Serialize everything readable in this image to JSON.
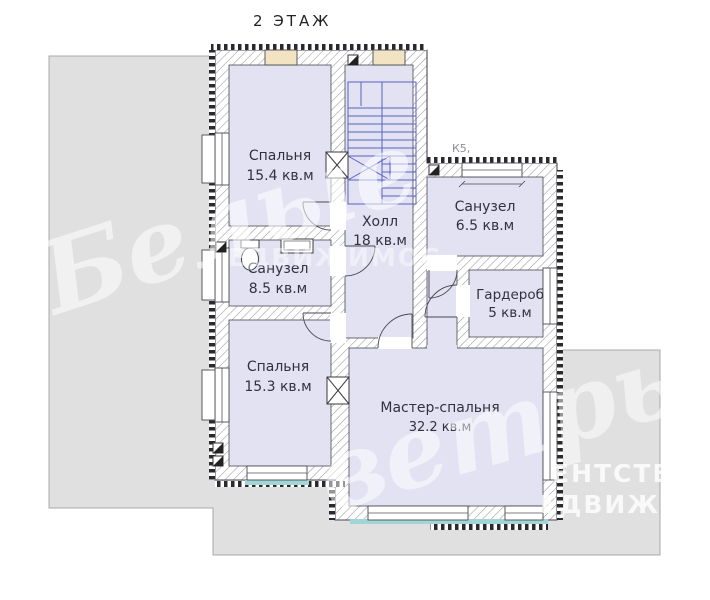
{
  "title": "2 ЭТАЖ",
  "section_mark_label": "К5,",
  "rooms": {
    "bedroom1": {
      "name": "Спальня",
      "area": "15.4 кв.м"
    },
    "hall": {
      "name": "Холл",
      "area": "18 кв.м"
    },
    "bathroom1": {
      "name": "Санузел",
      "area": "6.5 кв.м"
    },
    "bathroom2": {
      "name": "Санузел",
      "area": "8.5 кв.м"
    },
    "wardrobe": {
      "name": "Гардероб",
      "area": "5 кв.м"
    },
    "bedroom2": {
      "name": "Спальня",
      "area": "15.3 кв.м"
    },
    "master": {
      "name": "Мастер-спальня",
      "area": "32.2 кв.м"
    }
  },
  "watermark": {
    "script1": "Белые",
    "script2": "ветры",
    "caps1": "ЕНТСТВО",
    "caps2": "ЕДВИЖИМО",
    "caps_faint": "ЕДВИЖИМОС"
  },
  "colors": {
    "room_fill": "#e2e2f3",
    "terrace_gray": "#e0e0e0",
    "terrace_border": "#a9a9a9",
    "stairs": "#5a61c0",
    "window_tan": "#f2e4c3",
    "sill_teal": "#a2d6d6",
    "wall_outline": "#4a4a52"
  }
}
